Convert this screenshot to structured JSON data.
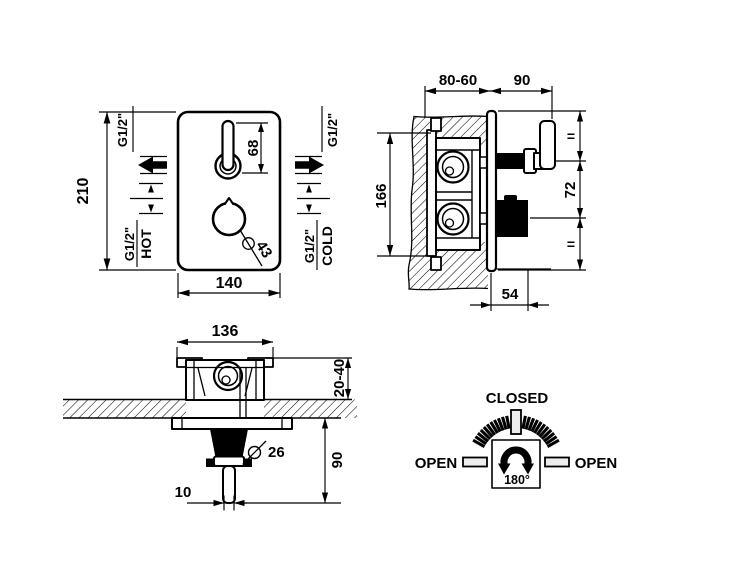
{
  "views": {
    "front": {
      "height": "210",
      "width": "140",
      "lever_length": "68",
      "knob_diameter": "43",
      "outlet_left_size": "G1/2\"",
      "outlet_right_size": "G1/2\"",
      "hot_size": "G1/2\"",
      "hot_label": "HOT",
      "cold_size": "G1/2\"",
      "cold_label": "COLD"
    },
    "side": {
      "recess_depth_range": "80-60",
      "handle_projection": "90",
      "body_height": "166",
      "equal_top": "=",
      "handle_knob_spacing": "72",
      "equal_bottom": "=",
      "knob_projection": "54"
    },
    "top": {
      "body_width": "136",
      "wall_depth_range": "20-40",
      "projection": "90",
      "knob_diameter": "26",
      "lever_width": "10"
    },
    "dial": {
      "closed_label": "CLOSED",
      "open_left_label": "OPEN",
      "open_right_label": "OPEN",
      "rotation_angle": "180°"
    }
  }
}
